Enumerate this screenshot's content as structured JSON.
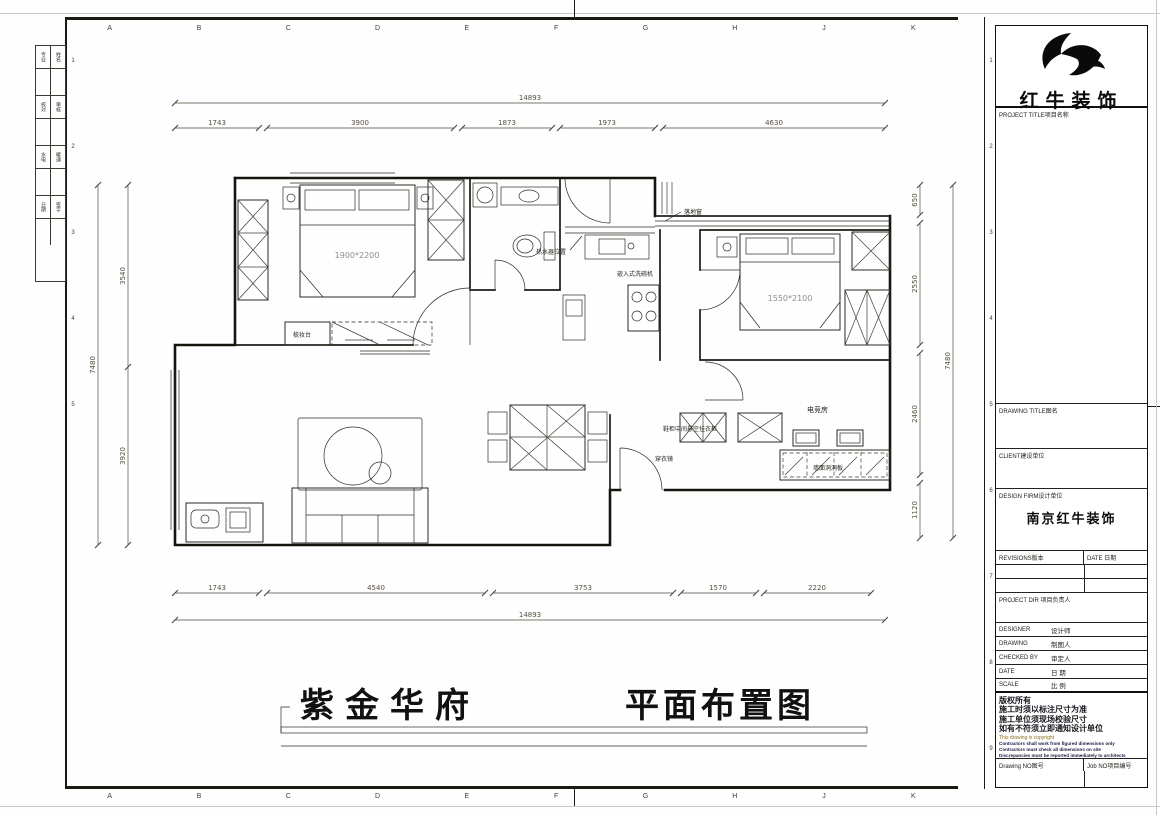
{
  "sheet": {
    "grid_letters": [
      "A",
      "B",
      "C",
      "D",
      "E",
      "F",
      "G",
      "H",
      "J",
      "K"
    ],
    "grid_numbers": [
      "1",
      "2",
      "3",
      "4",
      "5",
      "6",
      "7",
      "8",
      "9"
    ],
    "edge_strip": {
      "r1a": "专业",
      "r1b": "姓名",
      "r2a": "校对",
      "r2b": "审核",
      "r3a": "水电",
      "r3b": "暖通",
      "r4a": "日期",
      "r4b": "签字"
    }
  },
  "title_block": {
    "brand": "红牛装饰",
    "project_title": "PROJECT TITLE项目名称",
    "drawing_title": "DRAWING TITLE图名",
    "client": "CLIENT建设单位",
    "design_firm": "DESIGN FIRM设计单位",
    "design_firm_value": "南京红牛装饰",
    "revisions": "REVISIONS版本",
    "date_header": "DATE 日期",
    "project_dir": "PROJECT DIR 项目负责人",
    "rows": {
      "designer_en": "DESIGNER",
      "designer_cn": "设计师",
      "drawing_en": "DRAWING",
      "drawing_cn": "制图人",
      "checked_en": "CHECKED BY",
      "checked_cn": "审定人",
      "date_en": "DATE",
      "date_cn": "日 期",
      "scale_en": "SCALE",
      "scale_cn": "比 例"
    },
    "notes_cn": [
      "版权所有",
      "施工时须以标注尺寸为准",
      "施工单位须现场校验尺寸",
      "如有不符须立即通知设计单位"
    ],
    "notes_copyright": "This drawing is copyright",
    "notes_en": [
      "Contractors shall work from figured dimensions only",
      "Contractors must check all dimensions on site",
      "Discrepancies must be reported immediately to architects"
    ],
    "drawing_no": "Drawing NO图号",
    "job_no": "Job NO项目编号"
  },
  "plan": {
    "title_left": "紫金华府",
    "title_right": "平面布置图",
    "labels": {
      "floor_window": "落地窗",
      "water_heater": "热水器位置",
      "dishwasher": "嵌入式洗碗机",
      "dresser": "梳妆台",
      "bed_master": "1900*2200",
      "bed_second": "1550*2100",
      "shoe_cabinet": "鞋柜中间悬空挂衣柜",
      "mirror": "穿衣镜",
      "esports_room": "电竞房",
      "pegboard": "墙面洞洞板"
    },
    "dims": {
      "top_total": "14893",
      "top": [
        "1743",
        "3900",
        "1873",
        "1973",
        "4630"
      ],
      "bottom": [
        "1743",
        "4540",
        "3753",
        "1570",
        "2220"
      ],
      "bottom_total": "14893",
      "left": [
        "3540",
        "3920"
      ],
      "left_total": "7480",
      "right": [
        "650",
        "2550",
        "2460",
        "1120"
      ],
      "right_total": "7480"
    }
  }
}
